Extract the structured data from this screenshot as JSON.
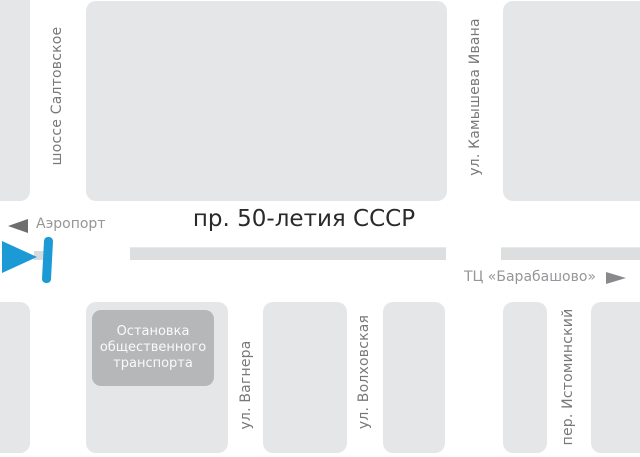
{
  "map_title": "Схема проезда",
  "main_road": {
    "title": "пр. 50-летия СССР"
  },
  "directions": {
    "airport": {
      "label": "Аэропорт",
      "arrow": "left"
    },
    "mall": {
      "label": "ТЦ «Барабашово»",
      "arrow": "right"
    }
  },
  "streets": [
    {
      "name": "шоссе Салтовское",
      "orientation": "vertical"
    },
    {
      "name": "ул. Камышева Ивана",
      "orientation": "vertical"
    },
    {
      "name": "ул. Вагнера",
      "orientation": "vertical"
    },
    {
      "name": "ул. Волховская",
      "orientation": "vertical"
    },
    {
      "name": "пер. Истоминский",
      "orientation": "vertical"
    }
  ],
  "bus_stop": {
    "lines": [
      "Остановка",
      "общественного",
      "транспорта"
    ]
  },
  "marker": {
    "type": "location-pointer"
  },
  "colors": {
    "background": "#ffffff",
    "block_fill": "#e5e6e8",
    "road_median": "#dcdee0",
    "bus_stop_fill": "#b5b7b9",
    "bus_stop_text": "#fafafa",
    "street_label_text": "#77787a",
    "direction_text": "#96969a",
    "direction_arrow_left": "#6e6e70",
    "direction_arrow_right": "#88898b",
    "title_text": "#2a2a2a",
    "marker_blue": "#1b9ad6"
  }
}
